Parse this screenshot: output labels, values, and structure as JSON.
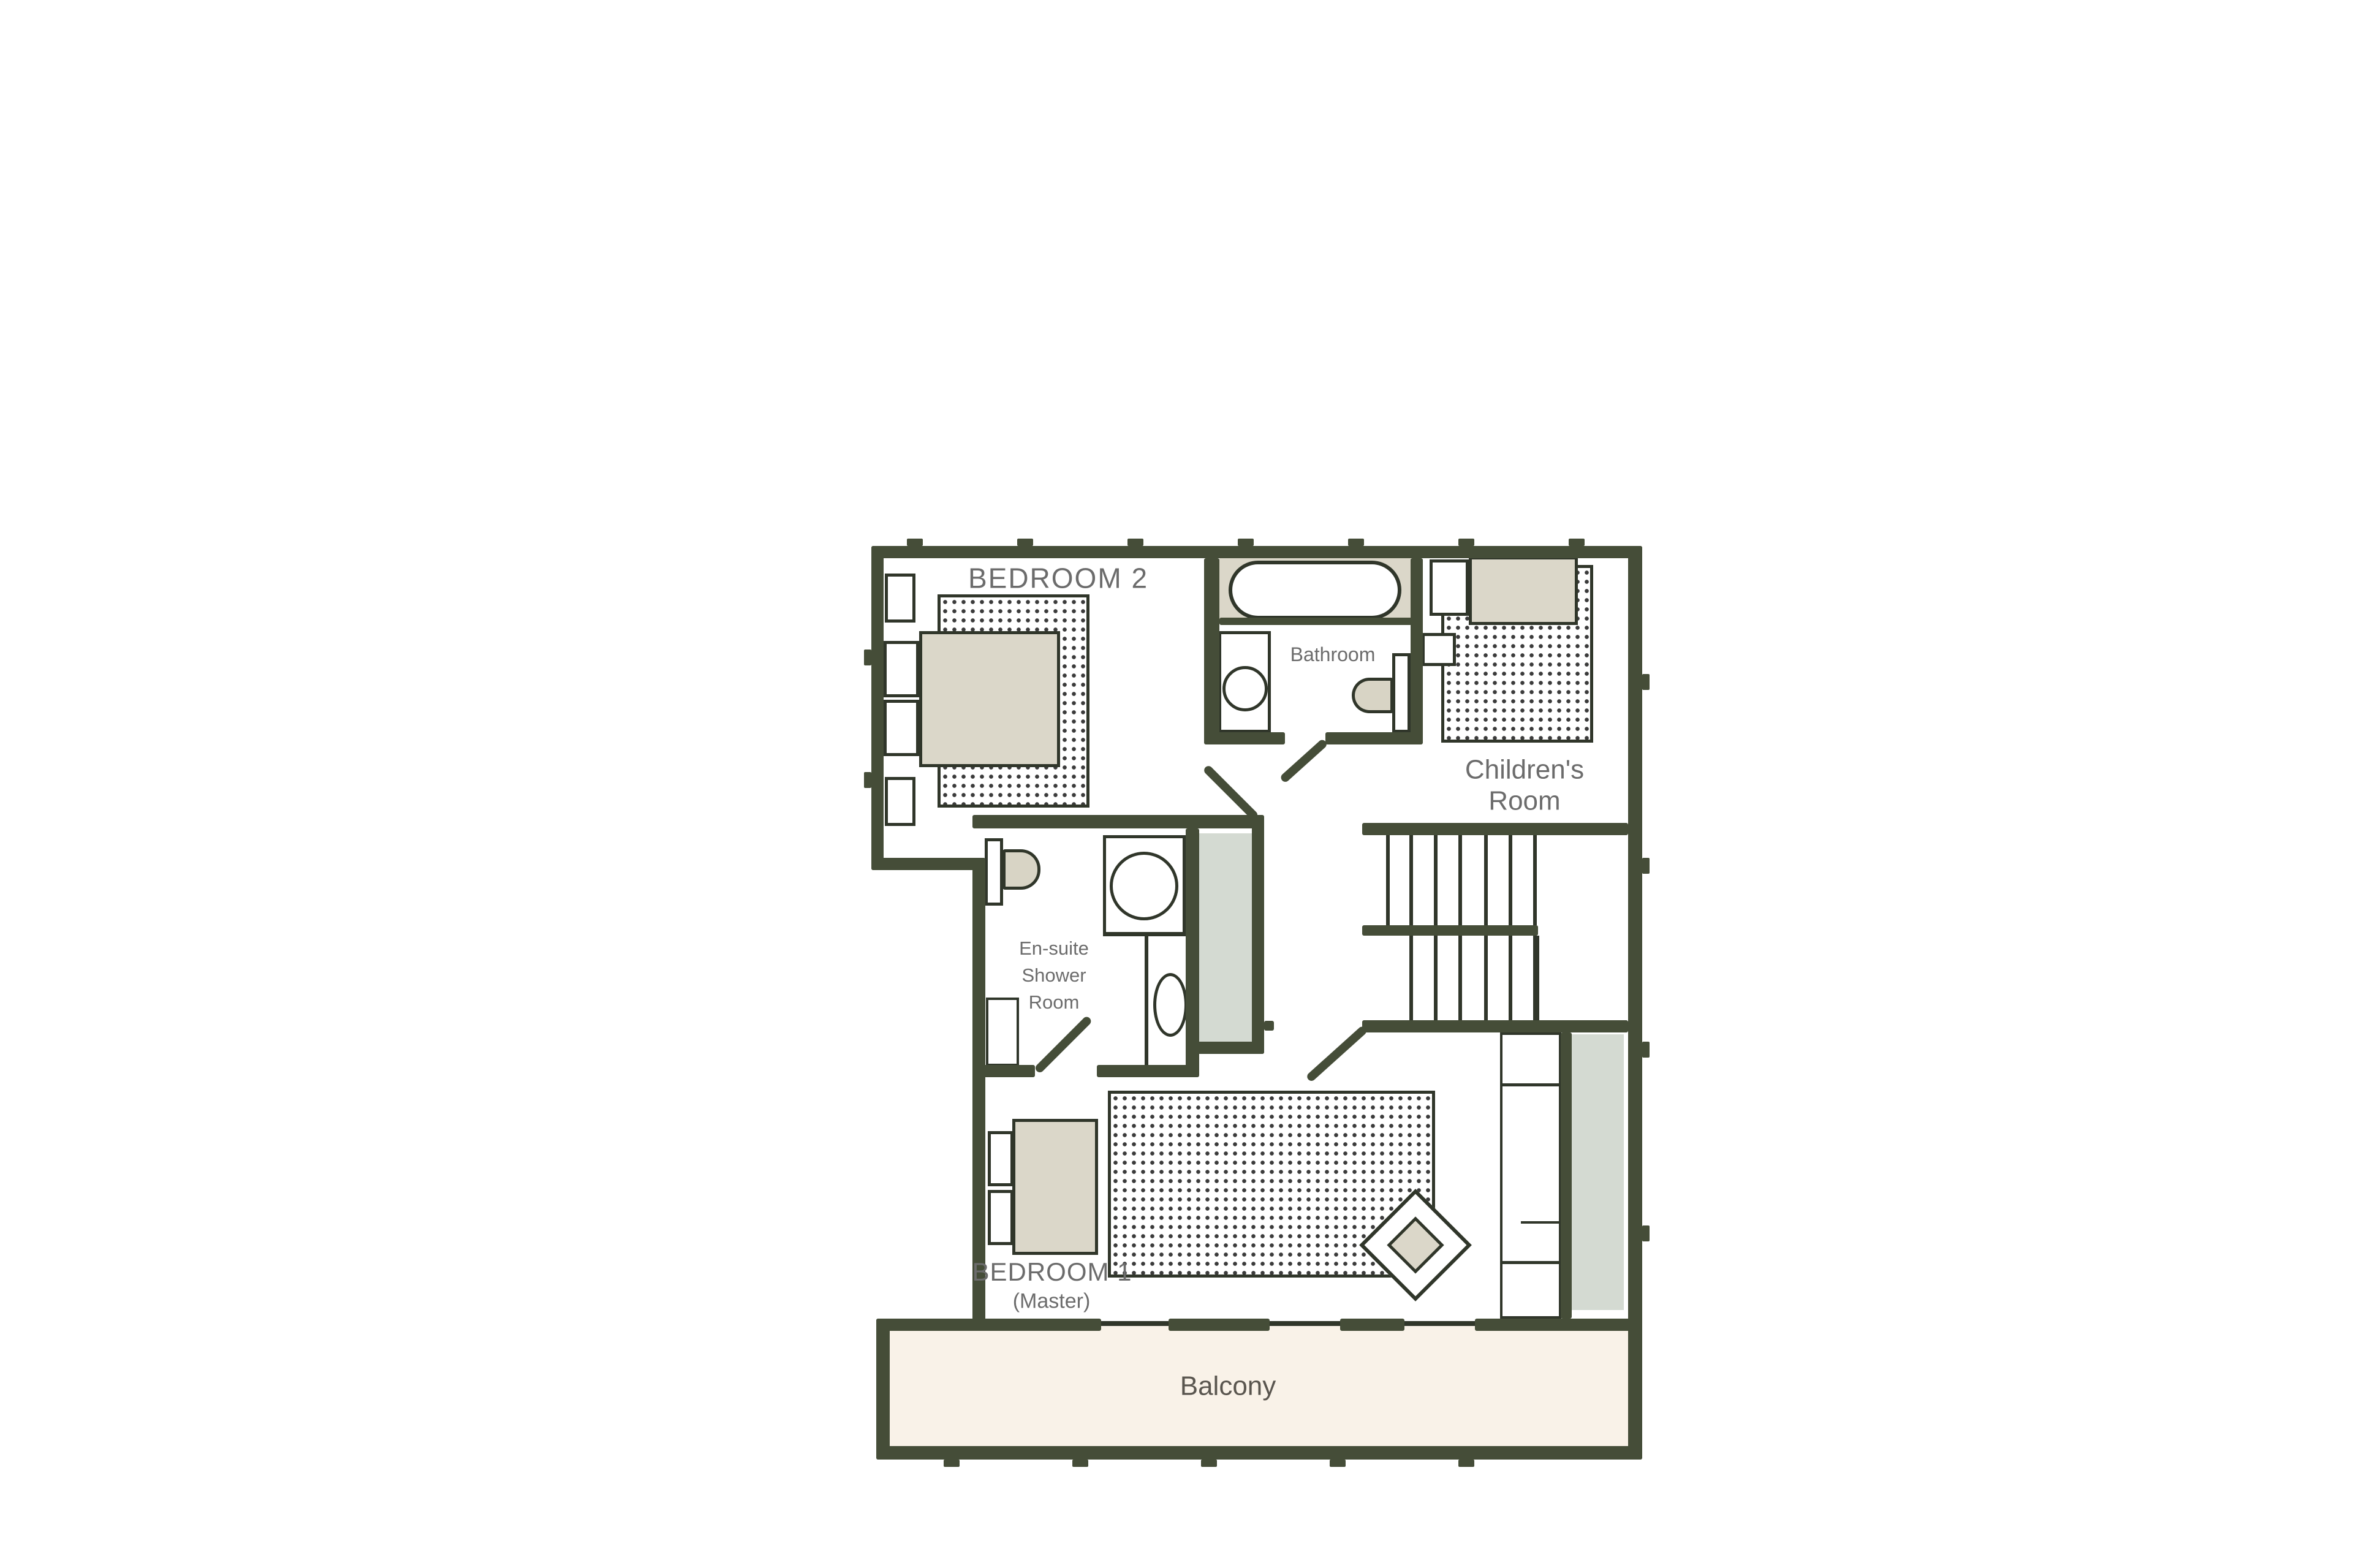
{
  "document": {
    "type": "floor-plan"
  },
  "colors": {
    "wall": "#454d38",
    "thin": "#30362a",
    "furn": "#dbd7c9",
    "fixture": "#d8d4c5",
    "grayzone": "#d4dad2",
    "balcony": "#f9f2e8",
    "label": "#6c6c6c",
    "dot": "#3b3b3b",
    "paper": "#ffffff"
  },
  "labels": {
    "bedroom2": "BEDROOM 2",
    "bathroom": "Bathroom",
    "childrens_room": "Children's\nRoom",
    "ensuite": "En-suite\nShower\nRoom",
    "bedroom1": "BEDROOM 1",
    "bedroom1_sub": "(Master)",
    "balcony": "Balcony"
  }
}
